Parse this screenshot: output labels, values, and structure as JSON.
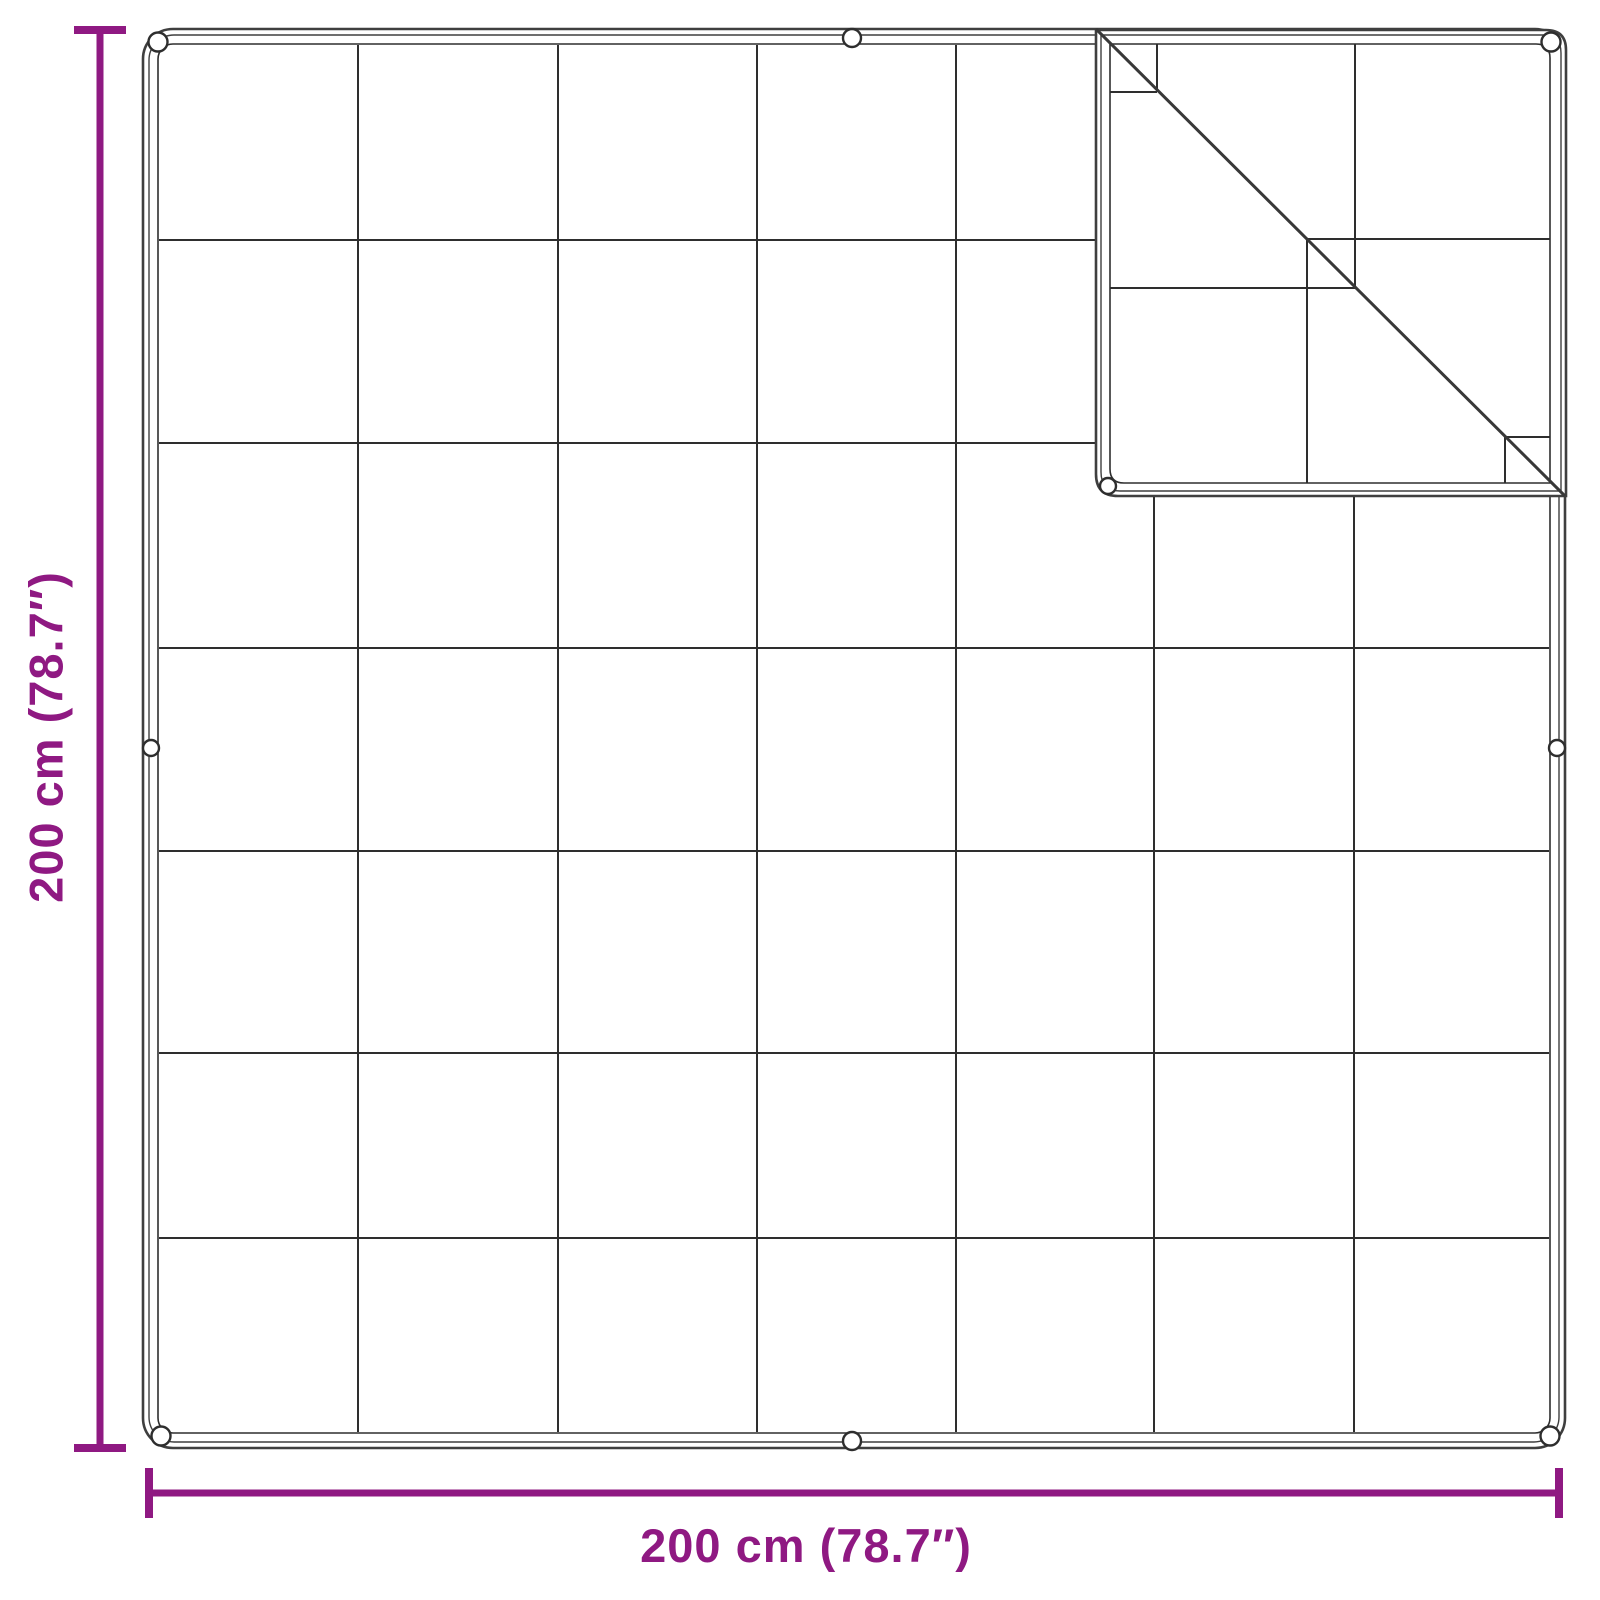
{
  "diagram": {
    "bottom_dimension_label": "200 cm (78.7″)",
    "left_dimension_label": "200 cm (78.7″)",
    "grid_columns": 7,
    "grid_rows": 7,
    "grommet_count": 9,
    "colors": {
      "accent": "#8F1982",
      "ink": "#2e2e2e",
      "edge": "#3f3f3f",
      "background": "#ffffff"
    }
  }
}
